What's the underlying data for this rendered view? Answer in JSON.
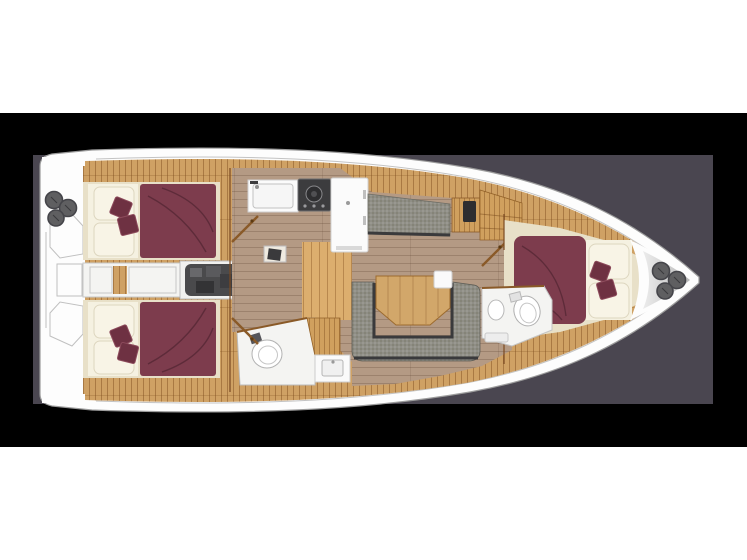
{
  "scene": {
    "kind": "yacht-interior-floor-plan",
    "view": "top-down",
    "bow_direction": "right"
  },
  "palette": {
    "page": "#ffffff",
    "background": "#000000",
    "panel": "#4a4650",
    "hull-white": "#fdfdfd",
    "hull-line": "#9c9c9c",
    "deck-wood": "#cfa164",
    "steps-wood": "#dcae6e",
    "furniture-wood": "#d0a05e",
    "table-wood": "#d2a76a",
    "floor-wood": "#b49a84",
    "cabin-beige": "#e8e0c8",
    "cushion-cream": "#f5f1e1",
    "bed-maroon": "#7d3c4d",
    "pillow-maroon": "#6e3142",
    "fabric-gray": "#8f8e86",
    "trim-dark": "#3a3a3c",
    "engine-gray": "#4a4a4c",
    "counter-white": "#fbfbfb",
    "stove-dark": "#3c3c3e",
    "fixture-white": "#f4f4f2",
    "winch-gray": "#5f5f61",
    "wall-brown": "#8a5a28",
    "bow-deck-gray": "#b9b9b9"
  },
  "regions": {
    "stern_platform": "stern-platform",
    "aft_cabin_port": "aft-cabin-port",
    "aft_cabin_starboard": "aft-cabin-starboard",
    "engine_room": "engine-room",
    "companionway": "companionway-steps",
    "galley": "galley",
    "salon": "salon",
    "settee_port": "port-settee",
    "dinette": "dinette-u-sofa",
    "aft_head": "aft-head",
    "forward_head": "forward-head",
    "forward_cabin": "forward-cabin",
    "bow_deck": "bow-deck"
  }
}
